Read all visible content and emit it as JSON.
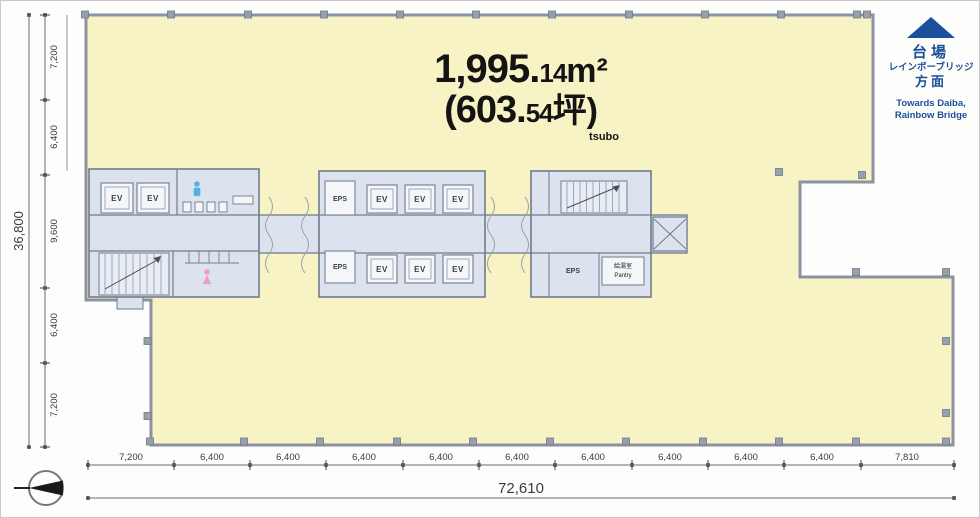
{
  "title": {
    "area_main": "1,995.",
    "area_dec": "14",
    "area_unit": "m²",
    "tsubo_main": "(603.",
    "tsubo_dec": "54",
    "tsubo_unit": "坪)",
    "tsubo_caption": "tsubo"
  },
  "direction_sign": {
    "jp1": "台場",
    "jp2": "レインボーブリッジ",
    "jp3": "方面",
    "en1": "Towards Daiba,",
    "en2": "Rainbow Bridge"
  },
  "dimensions": {
    "left": {
      "total": "36,800",
      "segments": [
        "7,200",
        "6,400",
        "9,600",
        "6,400",
        "7,200"
      ]
    },
    "bottom": {
      "total": "72,610",
      "segments": [
        "7,200",
        "6,400",
        "6,400",
        "6,400",
        "6,400",
        "6,400",
        "6,400",
        "6,400",
        "6,400",
        "6,400",
        "7,810"
      ]
    }
  },
  "labels": {
    "ev": "EV",
    "eps": "EPS",
    "pantry_jp": "給湯室",
    "pantry_en": "Pantry"
  },
  "colors": {
    "floor": "#f8f3c5",
    "core": "#dde3ee",
    "wall": "#8a93a2",
    "accent": "#1c4f9c"
  }
}
